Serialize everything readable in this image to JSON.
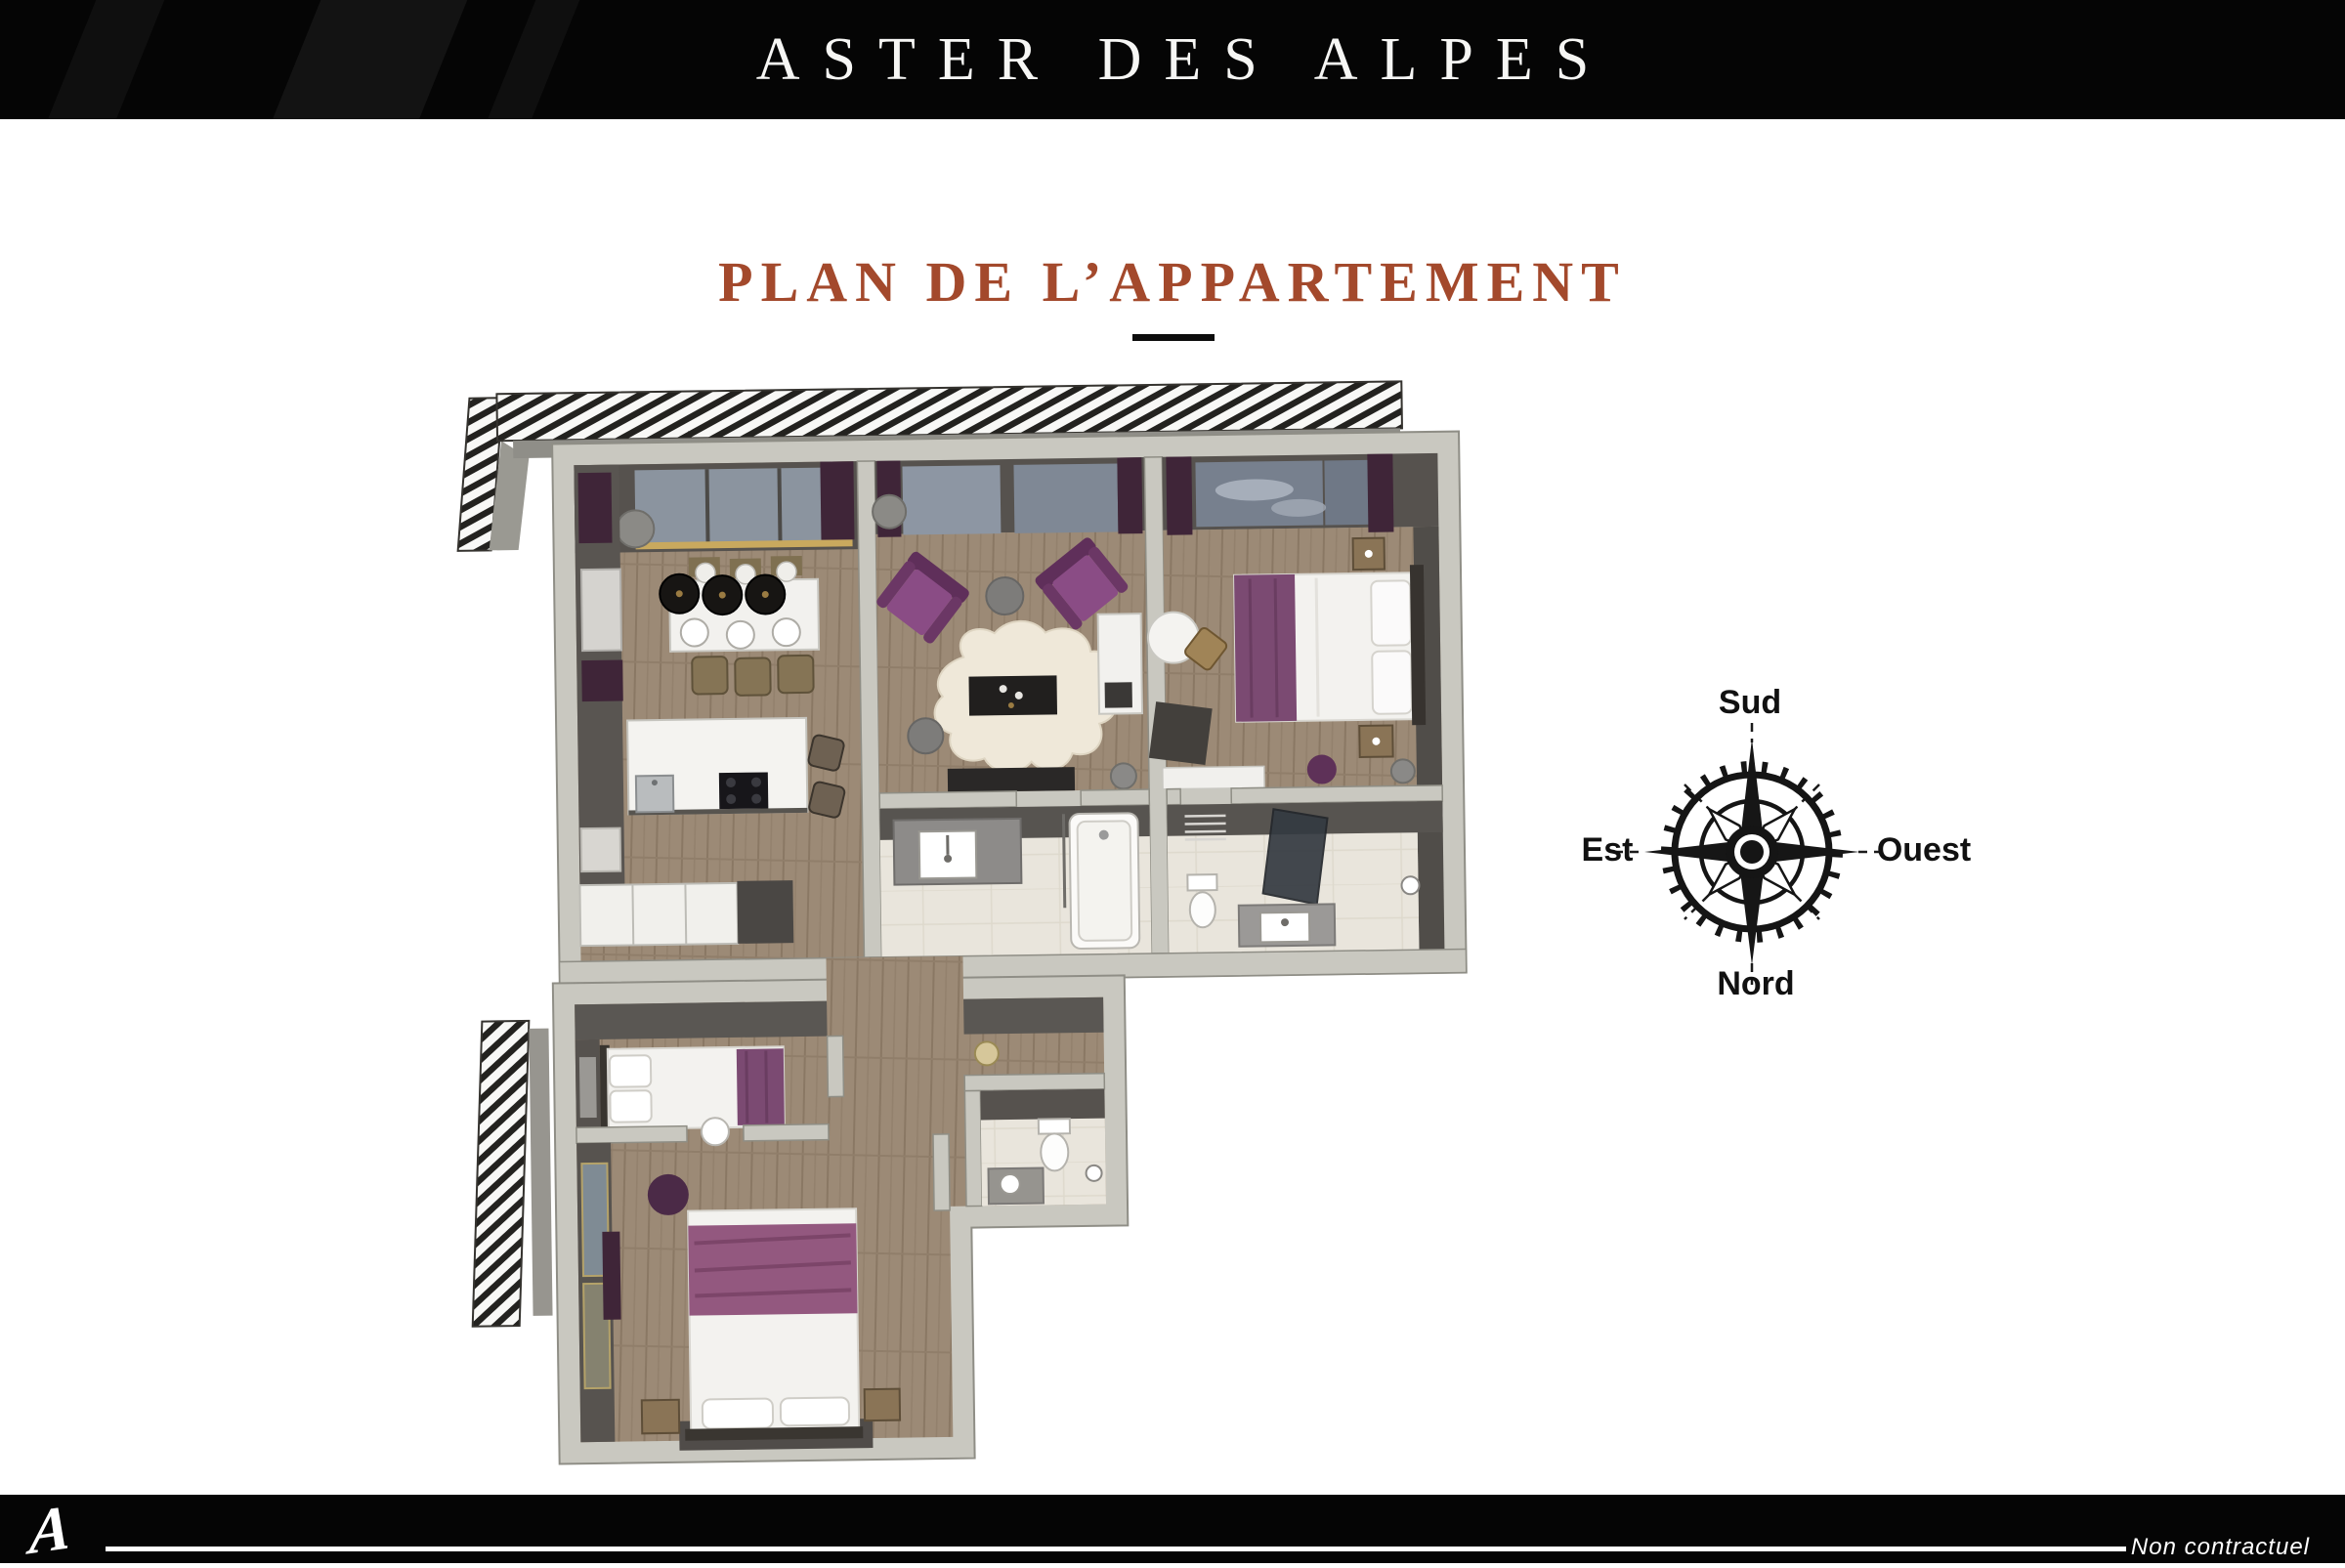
{
  "header": {
    "brand": "ASTER DES ALPES"
  },
  "main": {
    "title": "PLAN DE L’APPARTEMENT"
  },
  "compass": {
    "south_label": "Sud",
    "east_label": "Est",
    "west_label": "Ouest",
    "north_label": "Nord"
  },
  "footer": {
    "logo_letter": "A",
    "disclaimer": "Non contractuel"
  },
  "colors": {
    "page_bg": "#ffffff",
    "bar_bg": "#050505",
    "title_accent": "#A3492C",
    "title_rule": "#0c0c0c",
    "wall_light": "#c9c8c0",
    "wall_dark": "#57534f",
    "floor_wood": "#9c8a76",
    "floor_bath": "#e9e5dc",
    "window_glass": "#8b949f",
    "furniture_purple": "#8a4c85",
    "curtain_purple": "#3f2538",
    "bed_runner_purple": "#7b4a72",
    "compass_ink": "#141414"
  }
}
